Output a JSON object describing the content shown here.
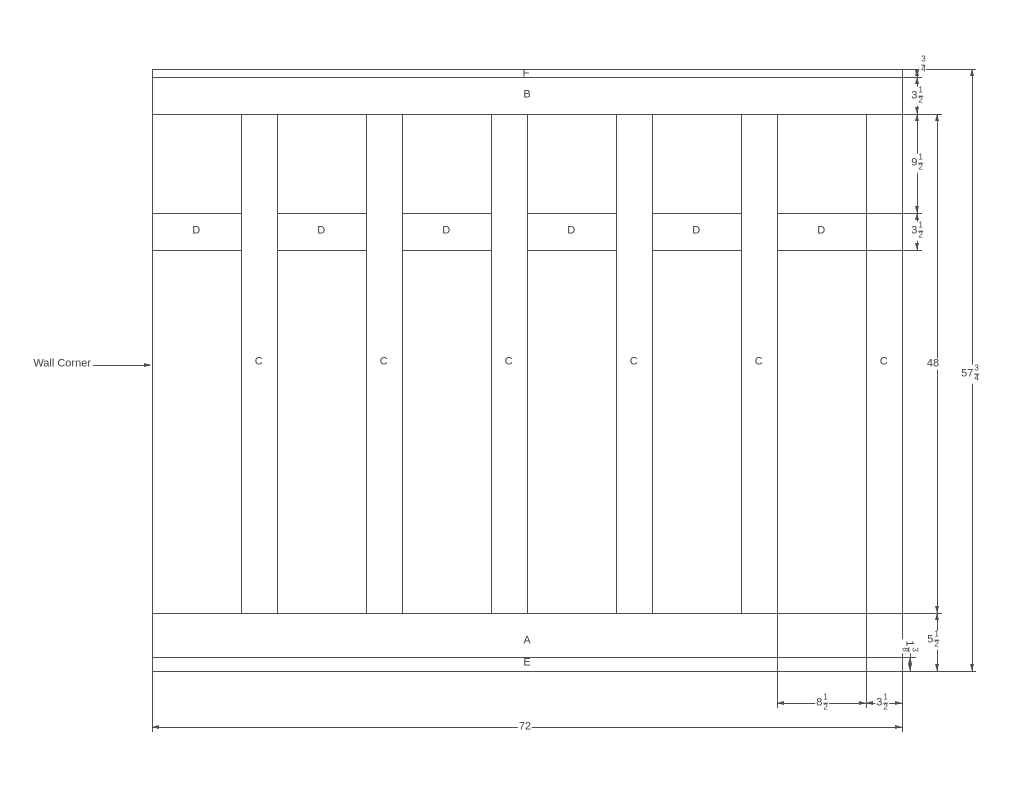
{
  "drawing": {
    "type": "wainscoting-elevation",
    "annotation": {
      "wall_corner": "Wall Corner"
    },
    "part_labels": {
      "top_cap": "F",
      "top_rail": "B",
      "batten": "C",
      "mid_rail": "D",
      "bottom_rail": "A",
      "base_cap": "E"
    },
    "dims": {
      "cap_height": {
        "num": "3",
        "den": "4"
      },
      "top_rail_height": {
        "whole": "3",
        "num": "1",
        "den": "2"
      },
      "rail_gap": {
        "whole": "9",
        "num": "1",
        "den": "2"
      },
      "mid_rail_height": {
        "whole": "3",
        "num": "1",
        "den": "2"
      },
      "field_height": {
        "whole": "48"
      },
      "bottom_section_height": {
        "whole": "5",
        "num": "1",
        "den": "2"
      },
      "base_cap_height": {
        "whole": "1",
        "num": "3",
        "den": "8"
      },
      "total_height": {
        "whole": "57",
        "num": "3",
        "den": "4"
      },
      "panel_width": {
        "whole": "8",
        "num": "1",
        "den": "2"
      },
      "batten_width": {
        "whole": "3",
        "num": "1",
        "den": "2"
      },
      "total_width": {
        "whole": "72"
      }
    },
    "colors": {
      "line": "#4d4d4d",
      "text": "#3f3f3f",
      "background": "#ffffff"
    }
  }
}
